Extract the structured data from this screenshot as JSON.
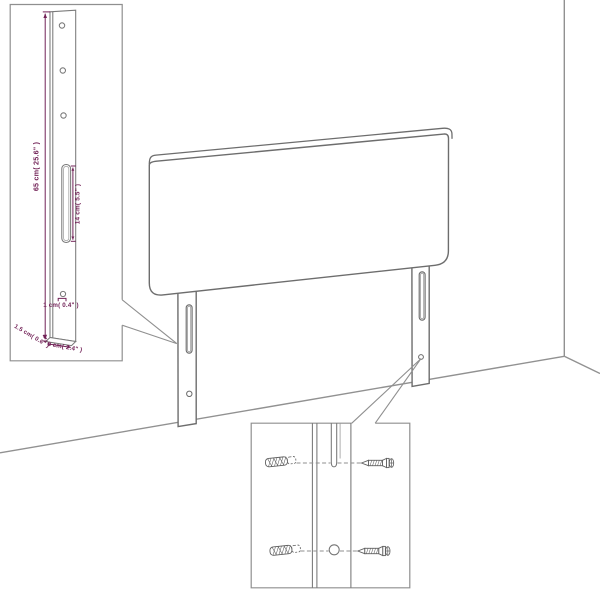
{
  "figure": {
    "kind": "product-assembly-dimension-diagram",
    "subject": "upholstered headboard with two mounting legs, leg detail inset and wall-fixing hardware inset"
  },
  "colors": {
    "background": "#ffffff",
    "furniture_outline": "#6d6d6d",
    "room_outline": "#919191",
    "detail_outline": "#7a7a7a",
    "dimension_accent": "#722257"
  },
  "labels": {
    "leg_height": "65 cm( 25.6\" )",
    "slot_length": "14 cm( 5.5\" )",
    "hole_diameter": "1 cm( 0.4\" )",
    "leg_thickness": "1.5 cm( 0.6\" )",
    "leg_width": "6 cm( 2.4\" )"
  }
}
